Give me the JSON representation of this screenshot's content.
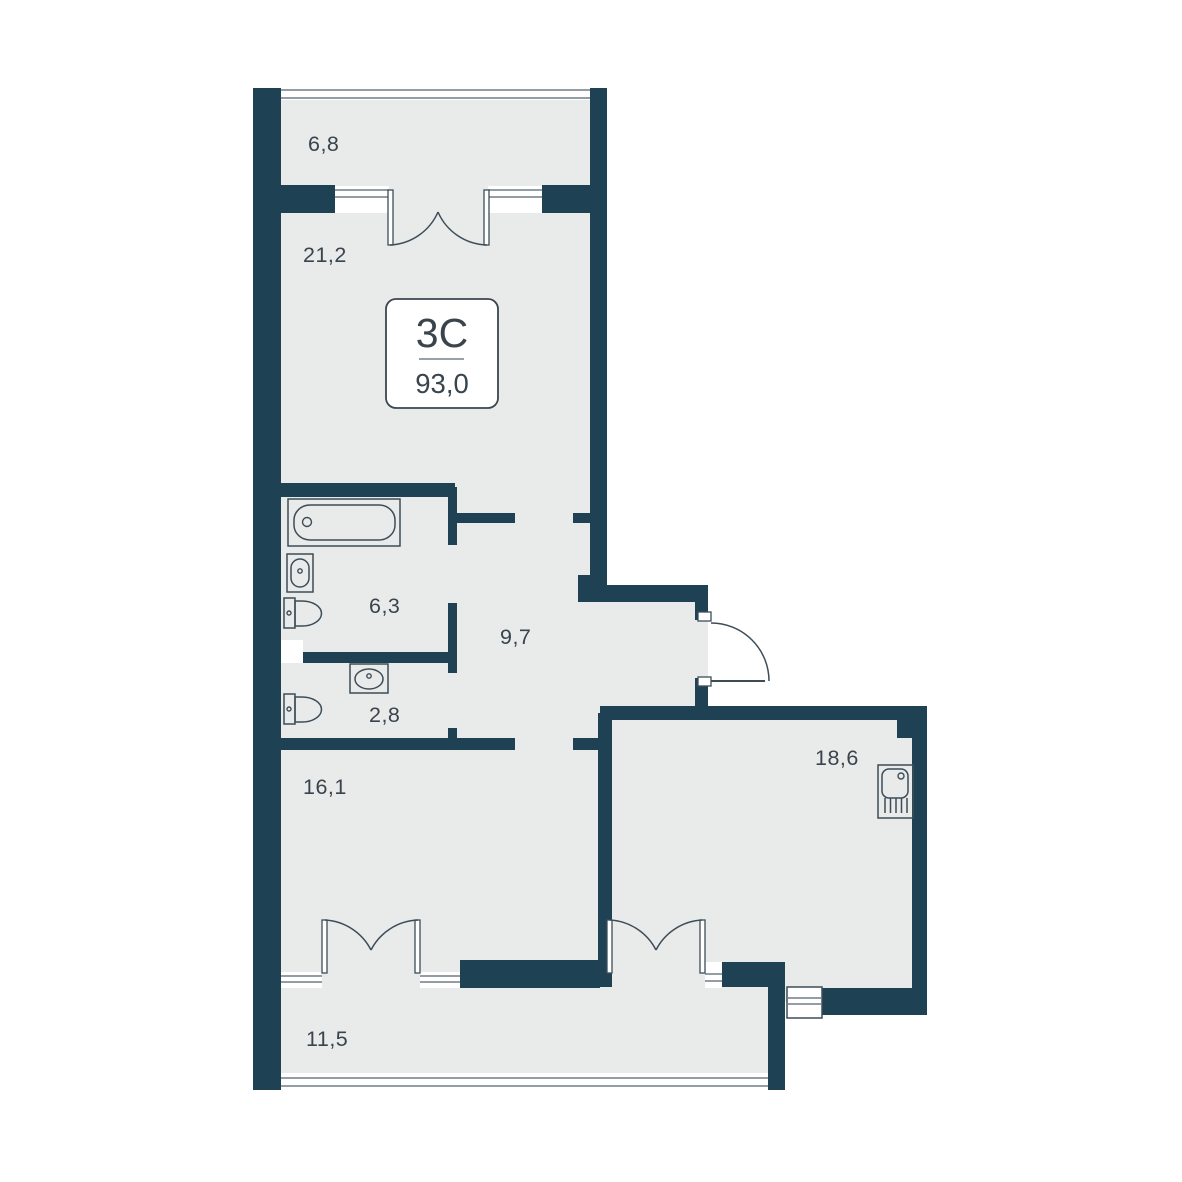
{
  "plan": {
    "badge": {
      "type_label": "3С",
      "area_label": "93,0"
    },
    "rooms": [
      {
        "name": "balcony-top",
        "area": "6,8"
      },
      {
        "name": "living-room",
        "area": "21,2"
      },
      {
        "name": "bathroom",
        "area": "6,3"
      },
      {
        "name": "hallway",
        "area": "9,7"
      },
      {
        "name": "wc",
        "area": "2,8"
      },
      {
        "name": "bedroom",
        "area": "16,1"
      },
      {
        "name": "kitchen-living",
        "area": "18,6"
      },
      {
        "name": "balcony-bottom",
        "area": "11,5"
      }
    ],
    "colors": {
      "wall": "#1e4254",
      "floor": "#e9eaea",
      "fixture_line": "#3d4d58",
      "text": "#39444c",
      "background": "#ffffff"
    }
  }
}
